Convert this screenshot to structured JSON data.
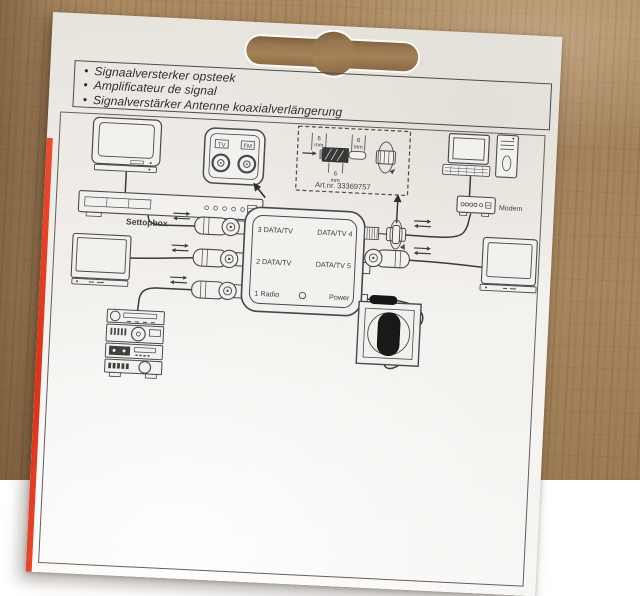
{
  "package": {
    "bullet_char": "•",
    "bullets": [
      "Signaalversterker opsteek",
      "Amplificateur de signal",
      "Signalverstärker Antenne koaxialverlängerung"
    ],
    "diagram": {
      "art_number": "Art.nr. 33369757",
      "dimension_value": "6",
      "dimension_unit": "mm",
      "wall_plate": {
        "left_port": "TV",
        "right_port": "FM"
      },
      "splitter_ports": {
        "left": [
          "3 DATA/TV",
          "2 DATA/TV",
          "1 Radio"
        ],
        "right": [
          "DATA/TV 4",
          "DATA/TV 5",
          "Power"
        ]
      },
      "device_labels": {
        "settopbox": "Settopbox",
        "modem": "Modem"
      }
    },
    "colors": {
      "accent_red": "#e23b22",
      "wood": "#a2825f",
      "cardboard": "#f4f2ee",
      "ink": "#3d3d3d"
    }
  }
}
